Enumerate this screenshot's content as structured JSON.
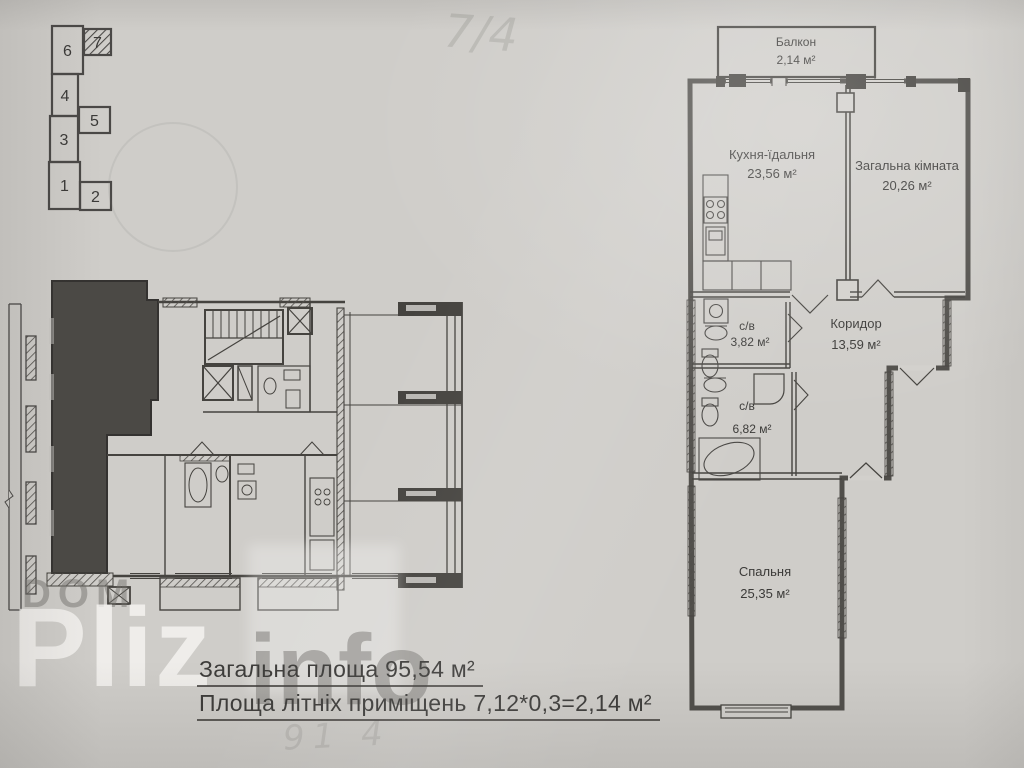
{
  "building_diagram": {
    "sections": [
      {
        "label": "1"
      },
      {
        "label": "2"
      },
      {
        "label": "3"
      },
      {
        "label": "4"
      },
      {
        "label": "5"
      },
      {
        "label": "6"
      },
      {
        "label": "7"
      }
    ],
    "highlighted_section": "7"
  },
  "apartment": {
    "balcony": {
      "name": "Балкон",
      "area": "2,14 м²"
    },
    "kitchen": {
      "name": "Кухня-їдальня",
      "area": "23,56 м²"
    },
    "living": {
      "name": "Загальна кімната",
      "area": "20,26 м²"
    },
    "corridor": {
      "name": "Коридор",
      "area": "13,59 м²"
    },
    "bath_small": {
      "name": "с/в",
      "area": "3,82 м²"
    },
    "bath_big": {
      "name": "с/в",
      "area": "6,82 м²"
    },
    "bedroom": {
      "name": "Спальня",
      "area": "25,35 м²"
    }
  },
  "summary": {
    "line1": "Загальна площа 95,54 м²",
    "line2": "Площа літніх приміщень  7,12*0,3=2,14 м²"
  },
  "watermark": {
    "dom": "DOM",
    "pliz": "Pliz",
    "info": "info"
  },
  "notes": {
    "top": "7/4",
    "bottom": "91 4"
  },
  "colors": {
    "paper": "#cfcdc9",
    "ink": "#45433f",
    "apartment_fill": "#4b4945"
  }
}
